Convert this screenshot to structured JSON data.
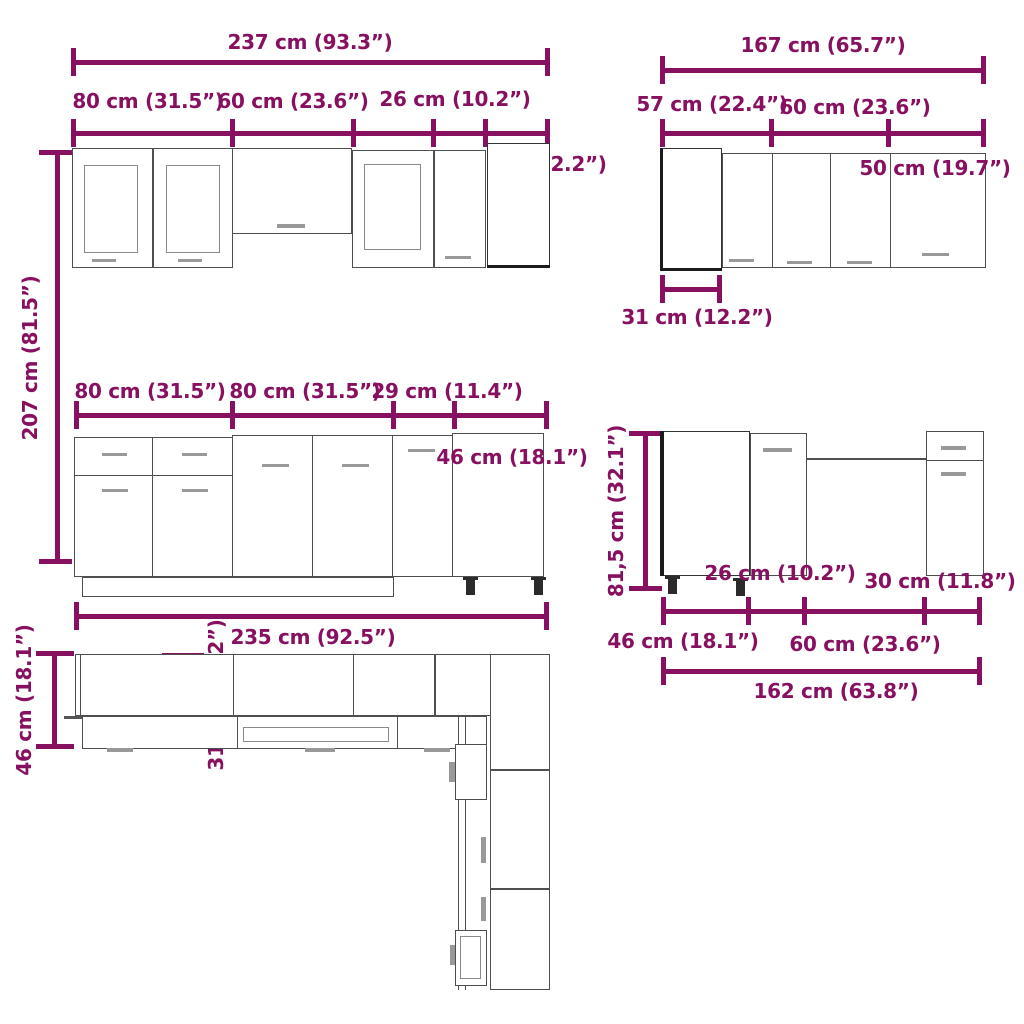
{
  "accent_color": "#871060",
  "sets": {
    "top_left": {
      "total": "237 cm (93.3”)",
      "seg_80": "80 cm (31.5”)",
      "seg_60": "60 cm (23.6”)",
      "seg_26": "26 cm (10.2”)",
      "seg_40": "40 cm (15.7”)",
      "seg_31": "31 cm (12.2”)",
      "height": "207 cm (81.5”)"
    },
    "top_right": {
      "total": "167 cm (65.7”)",
      "seg_57": "57 cm (22.4”)",
      "seg_60": "60 cm (23.6”)",
      "seg_50": "50 cm (19.7”)",
      "depth_31": "31 cm (12.2”)"
    },
    "middle_left": {
      "seg_80a": "80 cm (31.5”)",
      "seg_80b": "80 cm (31.5”)",
      "seg_29": "29 cm (11.4”)",
      "depth_46": "46 cm (18.1”)",
      "total": "235 cm (92.5”)"
    },
    "middle_right": {
      "height": "81,5 cm (32.1”)",
      "seg_26": "26 cm (10.2”)",
      "seg_30": "30 cm (11.8”)",
      "seg_46": "46 cm (18.1”)",
      "seg_60": "60 cm (23.6”)",
      "total": "162 cm (63.8”)"
    },
    "bottom_left": {
      "depth_46": "46 cm (18.1”)",
      "depth_31": "31 cm (12.2”)"
    }
  }
}
